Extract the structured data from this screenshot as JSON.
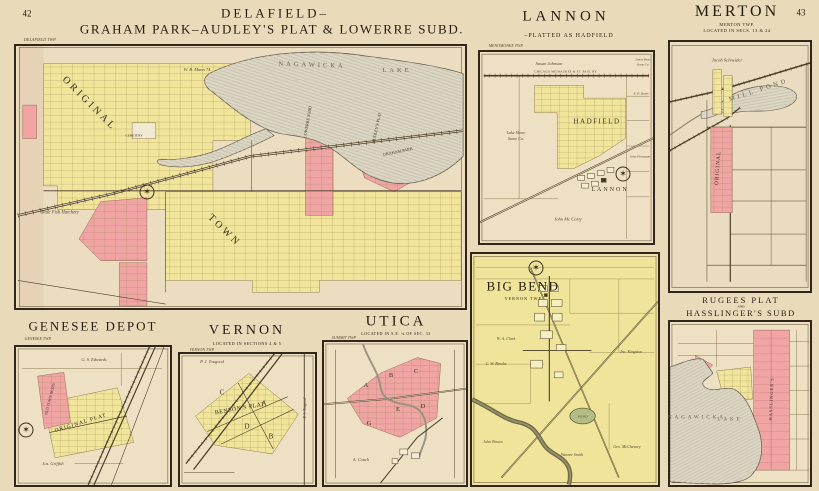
{
  "page": {
    "left_page_number": "42",
    "right_page_number": "43"
  },
  "delafield": {
    "title_line1": "DELAFIELD–",
    "title_line2": "GRAHAM PARK–AUDLEY'S PLAT & LOWERRE SUBD.",
    "twp": "DELAFIELD TWP.",
    "labels": {
      "original": "ORIGINAL",
      "town": "TOWN",
      "lake_word1": "NAGAWICKA",
      "lake_word2": "LAKE",
      "lowerre": "LOWERRE SUBD",
      "audleys": "AUDLEY'S PLAT",
      "graham": "GRAHAM PARK",
      "hatchery": "State Fish Hatchery",
      "cemetery": "CEMETERY",
      "mann": "W. B. Mann 74"
    }
  },
  "lannon": {
    "title": "LANNON",
    "subtitle": "–PLATTED AS HADFIELD",
    "twp": "MENOMONEE TWP.",
    "labels": {
      "railroad": "CHICAGO MILWAUKEE & ST. PAUL RY.",
      "susan": "Susan Johnson",
      "hadfield": "HADFIELD",
      "stoneco1": "Lake Shore",
      "stoneco2": "Stone Co.",
      "mccarty": "John Mc Carty",
      "lannon": "LANNON",
      "davis1": "Davis Bros.",
      "davis2": "Stone Co.",
      "epdavis": "E. P. Davis",
      "finnegan": "John Finnegan"
    }
  },
  "merton": {
    "title": "MERTON",
    "sub1": "MERTON TWP.",
    "sub2": "LOCATED IN SECS. 13 & 24",
    "labels": {
      "schneider": "Jacob Schneider",
      "millpond": "MILL POND",
      "original": "ORIGINAL"
    }
  },
  "bigbend": {
    "title": "BIG BEND",
    "twp": "VERNON TWP.",
    "labels": {
      "clark": "W. A. Clark",
      "brooks": "C. W. Brooks",
      "kingston": "Jno. Kingston",
      "pond": "POND",
      "brown": "John Brown",
      "smith": "Warner Smith",
      "mcchesney": "Geo. McChesney"
    }
  },
  "genesee": {
    "title": "GENESEE DEPOT",
    "twp": "GENESEE TWP.",
    "labels": {
      "edwards": "G. S. Edwards",
      "oldtown": "OLD TOWN RESID.",
      "originalplat": "ORIGINAL PLAT",
      "griffith": "Jos. Griffith"
    }
  },
  "vernon": {
    "title": "VERNON",
    "sub": "LOCATED IN SECTIONS 4 & 5",
    "twp": "VERNON TWP.",
    "labels": {
      "tougood": "P. J. Tougood",
      "bensons": "BENSON'S PLAT",
      "blockC": "C",
      "blockA": "A",
      "blockD": "D",
      "blockB": "B"
    }
  },
  "utica": {
    "title": "UTICA",
    "sub": "LOCATED IN S.E. ¼ OF SEC. 33",
    "twp": "SUMMIT TWP.",
    "labels": {
      "blockA": "A",
      "blockB": "B",
      "blockC": "C",
      "blockD": "D",
      "blockE": "E",
      "blockG": "G",
      "couch": "A. Couch"
    }
  },
  "rugees": {
    "title_line1": "RUGEES PLAT",
    "title_and": "AND",
    "title_line2": "HASSLINGER'S SUBD",
    "labels": {
      "lake1": "NAGAWICKA",
      "lake2": "LAKE",
      "hasslingers": "HASSLINGER'S"
    }
  }
}
